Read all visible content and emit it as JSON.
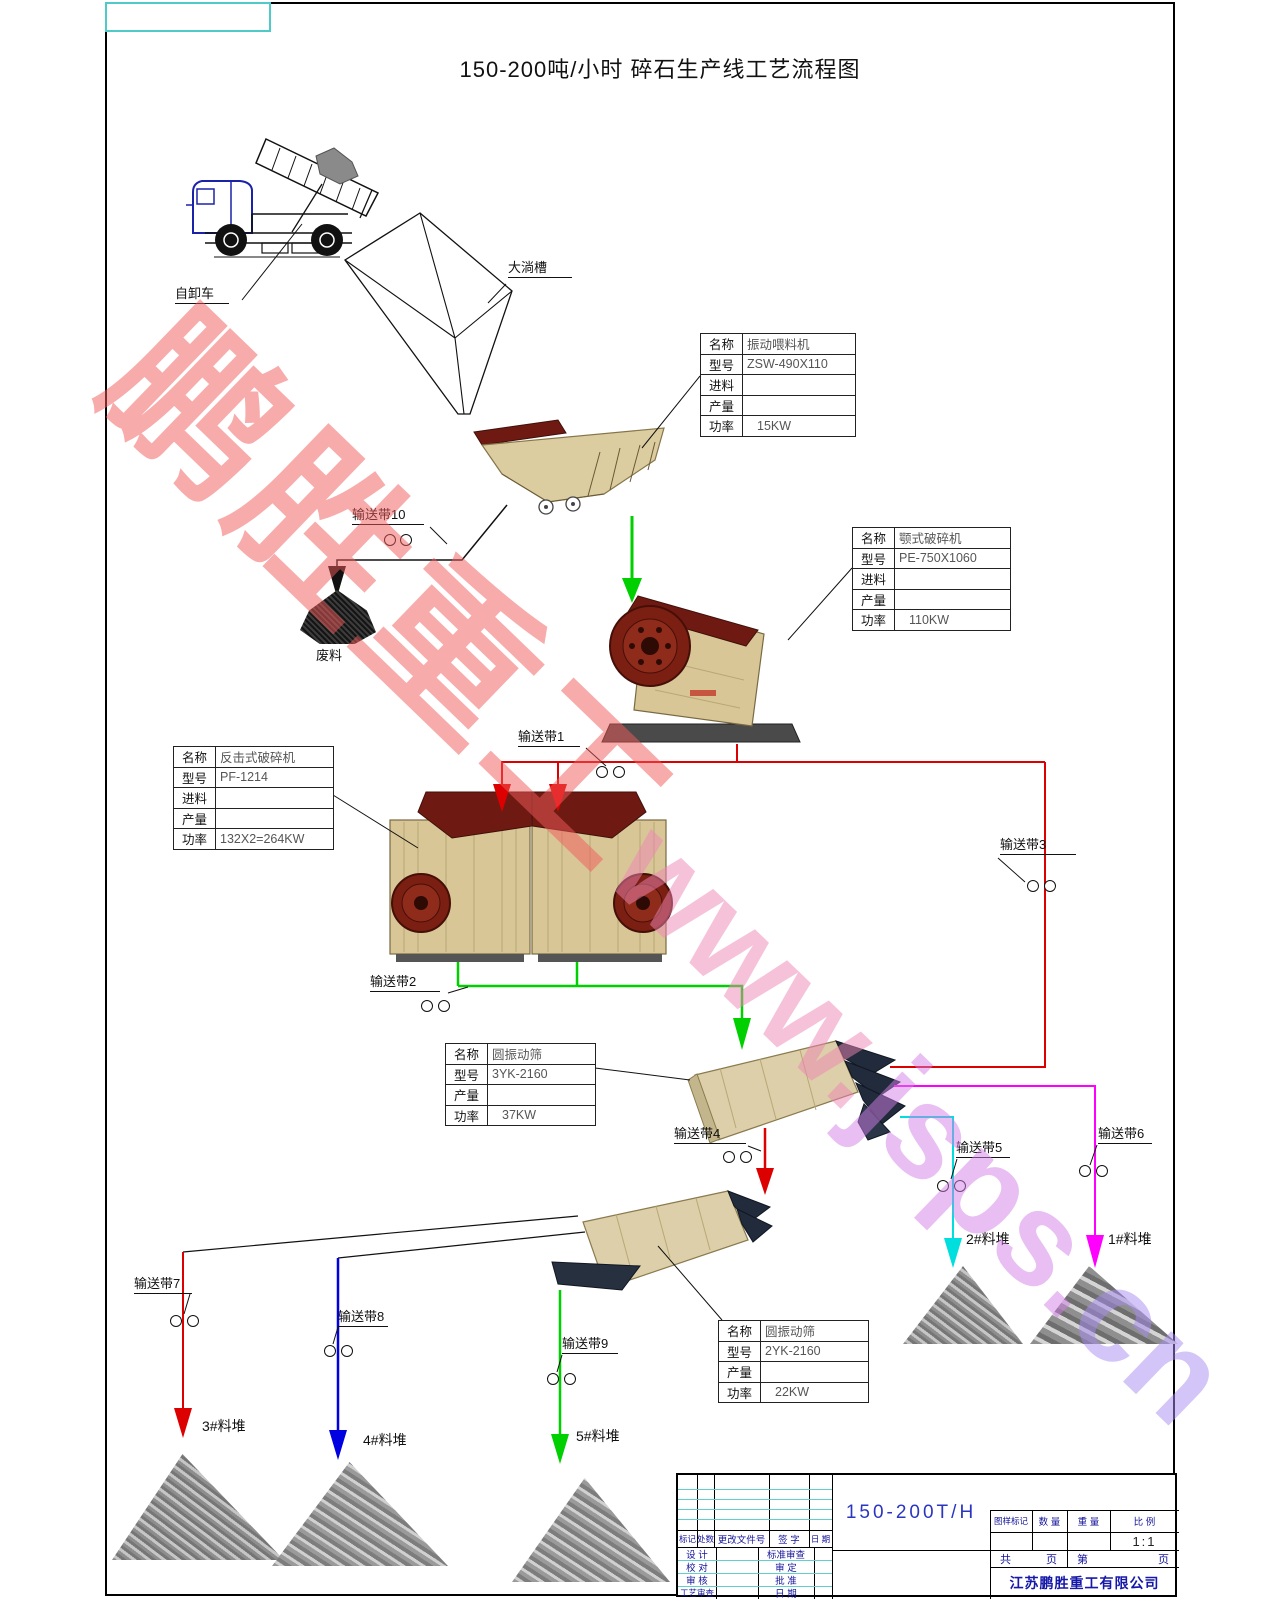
{
  "page_title": "150-200吨/小时  碎石生产线工艺流程图",
  "watermark": {
    "part1": "鹏胜重工",
    "part2": "www.",
    "part3": "jsps.",
    "part4": "cn"
  },
  "labels": {
    "truck": "自卸车",
    "hopper": "大淌槽",
    "waste": "废料",
    "belt1": "输送带1",
    "belt2": "输送带2",
    "belt3": "输送带3",
    "belt4": "输送带4",
    "belt5": "输送带5",
    "belt6": "输送带6",
    "belt7": "输送带7",
    "belt8": "输送带8",
    "belt9": "输送带9",
    "belt10": "输送带10",
    "pile1": "1#料堆",
    "pile2": "2#料堆",
    "pile3": "3#料堆",
    "pile4": "4#料堆",
    "pile5": "5#料堆"
  },
  "tables": {
    "feeder": {
      "rows": [
        [
          "名称",
          "振动喂料机"
        ],
        [
          "型号",
          "ZSW-490X110"
        ],
        [
          "进料",
          ""
        ],
        [
          "产量",
          ""
        ],
        [
          "功率",
          "15KW"
        ]
      ]
    },
    "jaw": {
      "rows": [
        [
          "名称",
          "颚式破碎机"
        ],
        [
          "型号",
          "PE-750X1060"
        ],
        [
          "进料",
          ""
        ],
        [
          "产量",
          ""
        ],
        [
          "功率",
          "110KW"
        ]
      ]
    },
    "impact": {
      "rows": [
        [
          "名称",
          "反击式破碎机"
        ],
        [
          "型号",
          "PF-1214"
        ],
        [
          "进料",
          ""
        ],
        [
          "产量",
          ""
        ],
        [
          "功率",
          "132X2=264KW"
        ]
      ]
    },
    "screen1": {
      "rows": [
        [
          "名称",
          "圆振动筛"
        ],
        [
          "型号",
          "3YK-2160"
        ],
        [
          "产量",
          ""
        ],
        [
          "功率",
          "37KW"
        ]
      ]
    },
    "screen2": {
      "rows": [
        [
          "名称",
          "圆振动筛"
        ],
        [
          "型号",
          "2YK-2160"
        ],
        [
          "产量",
          ""
        ],
        [
          "功率",
          "22KW"
        ]
      ]
    }
  },
  "titleblock": {
    "model": "150-200T/H",
    "rev_header": [
      "标记",
      "处数",
      "更改文件号",
      "签 字",
      "日 期"
    ],
    "sign_left": [
      "设 计",
      "校 对",
      "审 核",
      "工艺审查"
    ],
    "sign_right": [
      "标准审查",
      "审 定",
      "批 准",
      "日 期"
    ],
    "spec_header": [
      "图样标记",
      "数 量",
      "重 量",
      "比 例"
    ],
    "scale": "1:1",
    "pages_left": [
      "共",
      "页"
    ],
    "pages_right": [
      "第",
      "页"
    ],
    "company": "江苏鹏胜重工有限公司"
  },
  "colors": {
    "flow_red": "#dd0000",
    "flow_green": "#00cf00",
    "flow_cyan": "#00dede",
    "flow_magenta": "#ff00ff",
    "flow_blue": "#0000e0",
    "machine_tan": "#d8c697",
    "machine_maroon": "#6e1a12",
    "deck_navy": "#212b3c",
    "titleblock_blue": "#14149a",
    "watermark_red": "#f25a5a",
    "watermark_violet": "#d27fe8",
    "corner_teal": "#4ecbc9"
  }
}
